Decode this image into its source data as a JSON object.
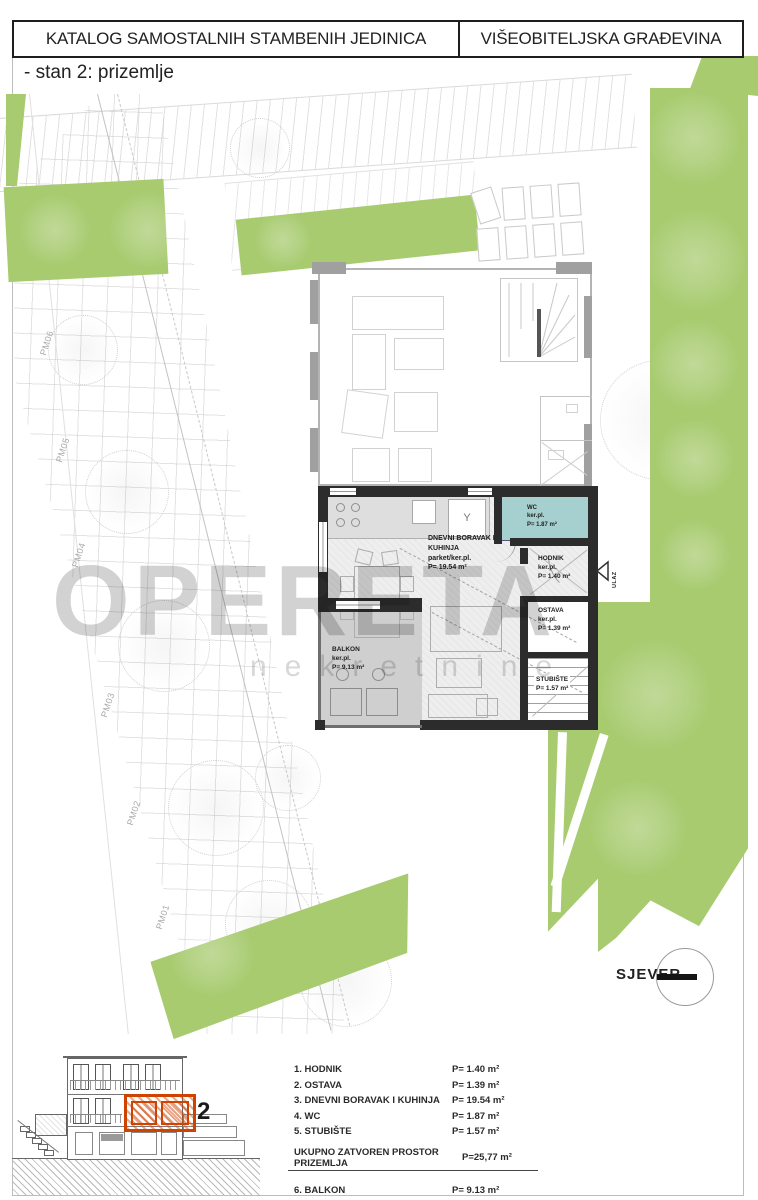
{
  "header": {
    "left_title": "KATALOG SAMOSTALNIH STAMBENIH JEDINICA",
    "right_title": "VIŠEOBITELJSKA GRAĐEVINA"
  },
  "subtitle": "- stan 2: prizemlje",
  "watermark": {
    "line1": "OPERETA",
    "line2": "nekretnine"
  },
  "plan": {
    "rooms": {
      "living": {
        "line1": "DNEVNI BORAVAK I",
        "line2": "KUHINJA",
        "floor": "parket/ker.pl.",
        "area": "P= 19.54 m²"
      },
      "wc": {
        "name": "WC",
        "floor": "ker.pl.",
        "area": "P= 1.87 m²"
      },
      "hodnik": {
        "name": "HODNIK",
        "floor": "ker.pl.",
        "area": "P= 1.40 m²"
      },
      "ostava": {
        "name": "OSTAVA",
        "floor": "ker.pl.",
        "area": "P= 1.39 m²"
      },
      "stubiste": {
        "name": "STUBIŠTE",
        "area": "P= 1.57 m²"
      },
      "balkon": {
        "name": "BALKON",
        "floor": "ker.pl.",
        "area": "P= 9.13 m²"
      }
    },
    "entrance_label": "ULAZ",
    "north_label": "SJEVER",
    "parking_labels": [
      "PM01",
      "PM02",
      "PM03",
      "PM04",
      "PM05",
      "PM06"
    ]
  },
  "elevation": {
    "unit_number": "2"
  },
  "legend": {
    "rows": [
      {
        "label": "1. HODNIK",
        "area": "P= 1.40 m²"
      },
      {
        "label": "2. OSTAVA",
        "area": "P= 1.39 m²"
      },
      {
        "label": "3. DNEVNI BORAVAK I KUHINJA",
        "area": "P= 19.54 m²"
      },
      {
        "label": "4. WC",
        "area": "P= 1.87 m²"
      },
      {
        "label": "5. STUBIŠTE",
        "area": "P= 1.57 m²"
      }
    ],
    "total": {
      "label": "UKUPNO ZATVOREN PROSTOR PRIZEMLJA",
      "area": "P=25,77 m²"
    },
    "extra": {
      "label": "6. BALKON",
      "area": "P= 9.13 m²"
    }
  },
  "colors": {
    "green": "#a8cb70",
    "wall_dark": "#2c2c2c",
    "wc_teal": "#a6d0d0",
    "balcony_gray": "#cfcfcf",
    "highlight_orange": "#cf4300"
  }
}
